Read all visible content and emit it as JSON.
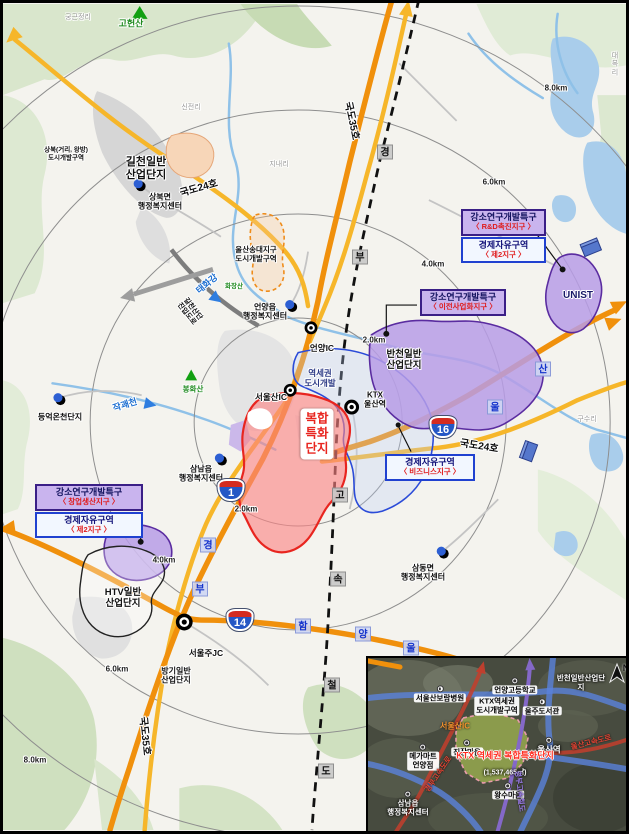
{
  "colors": {
    "road_national": "#f8c544",
    "road_expressway": "#f2930d",
    "rail_line": "#111111",
    "zone_purple_fill": "#b79ce6",
    "zone_purple_border": "#5a2ca0",
    "site_red_fill": "#fc8282",
    "site_red_border": "#e8251f",
    "fez_border_blue": "#2041d0",
    "water": "#a9cdeb"
  },
  "rings": {
    "labels": [
      "2.0km",
      "4.0km",
      "6.0km",
      "8.0km"
    ]
  },
  "roads": {
    "gukdo24": "국도24호",
    "gukdo35": "국도35호",
    "shield1": "1",
    "shield14": "14",
    "shield16": "16",
    "ktx_chars": [
      "경",
      "부",
      "고",
      "속",
      "철",
      "도"
    ],
    "hamyang_chars": [
      "함",
      "양",
      "울"
    ],
    "ulsanhwy_chars": [
      "울",
      "산"
    ],
    "gyeongbu_chars": [
      "경",
      "부"
    ],
    "gilcheon_access": "길천산단\n진입도로"
  },
  "waters": {
    "taehwagang": "태화강",
    "jakgwaecheon": "작괘천"
  },
  "mountains": {
    "goheonsan": "고헌산",
    "bonghwasan": "봉화산",
    "hwajangsan": "화장산"
  },
  "sites": {
    "gilcheon": "길천일반\n산업단지",
    "sangbuk_zone": "상북(거리, 왕방)\n도시개발구역",
    "songdae_zone": "울산송대지구\n도시개발구역",
    "bancheon": "반천일반\n산업단지",
    "unist": "UNIST",
    "htv": "HTV일반\n산업단지",
    "banggi": "방기일반\n산업단지",
    "hybrid": "복합\n특화\n단지",
    "yeokse_zone": "역세권\n도시개발",
    "deungeok": "등억온천단지"
  },
  "facilities": {
    "sangbuk_center": "상북면\n행정복지센터",
    "eonyang_center": "언양읍\n행정복지센터",
    "samnam_center": "삼남읍\n행정복지센터",
    "samdong_center": "삼동면\n행정복지센터",
    "eonyang_ic": "언양IC",
    "seoulsan_ic": "서울산IC",
    "ktx_station": "KTX\n울산역",
    "seoulju_jc": "서울주JC"
  },
  "zone_boxes": {
    "unist_sez_title": "강소연구개발특구",
    "unist_sez_sub": "〈 R&D촉진지구 〉",
    "unist_fez_title": "경제자유구역",
    "unist_fez_sub": "〈 제2지구 〉",
    "bancheon_sez_title": "강소연구개발특구",
    "bancheon_sez_sub": "〈 이전사업화지구 〉",
    "business_fez_title": "경제자유구역",
    "business_fez_sub": "〈 비즈니스지구 〉",
    "htv_sez_title": "강소연구개발특구",
    "htv_sez_sub": "〈 창업생산지구 〉",
    "htv_fez_title": "경제자유구역",
    "htv_fez_sub": "〈 제2지구 〉"
  },
  "minor_places": {
    "gunggeunjeong": "궁근정리",
    "sinjeon": "신전리",
    "jinae": "지내리",
    "daebok": "대복리",
    "gusu": "구수리"
  },
  "inset": {
    "boram_hospital": "서울산보람병원",
    "eonyang_hs": "언양고등학교",
    "bancheon": "반천일반산업단지",
    "ulju_library": "울주도서관",
    "ktx_zone": "KTX역세권\n도시개발구역",
    "seoulsan_ic": "서울산IC",
    "jinjang": "진장마을",
    "ulsan_station": "울산역",
    "hybrid_site": "KTX 역세권\n복합특화단지",
    "hybrid_area": "(1,537,465㎡)",
    "megamart": "메가마트\n언양점",
    "wangsu": "왕수마을",
    "samnam_center": "삼남읍\n행정복지센터",
    "gyeongbu_expwy": "경부고속도로",
    "ulsan_expwy": "울산고속도로",
    "gyeongbu_ktx": "경부고속철도",
    "north": "N"
  }
}
